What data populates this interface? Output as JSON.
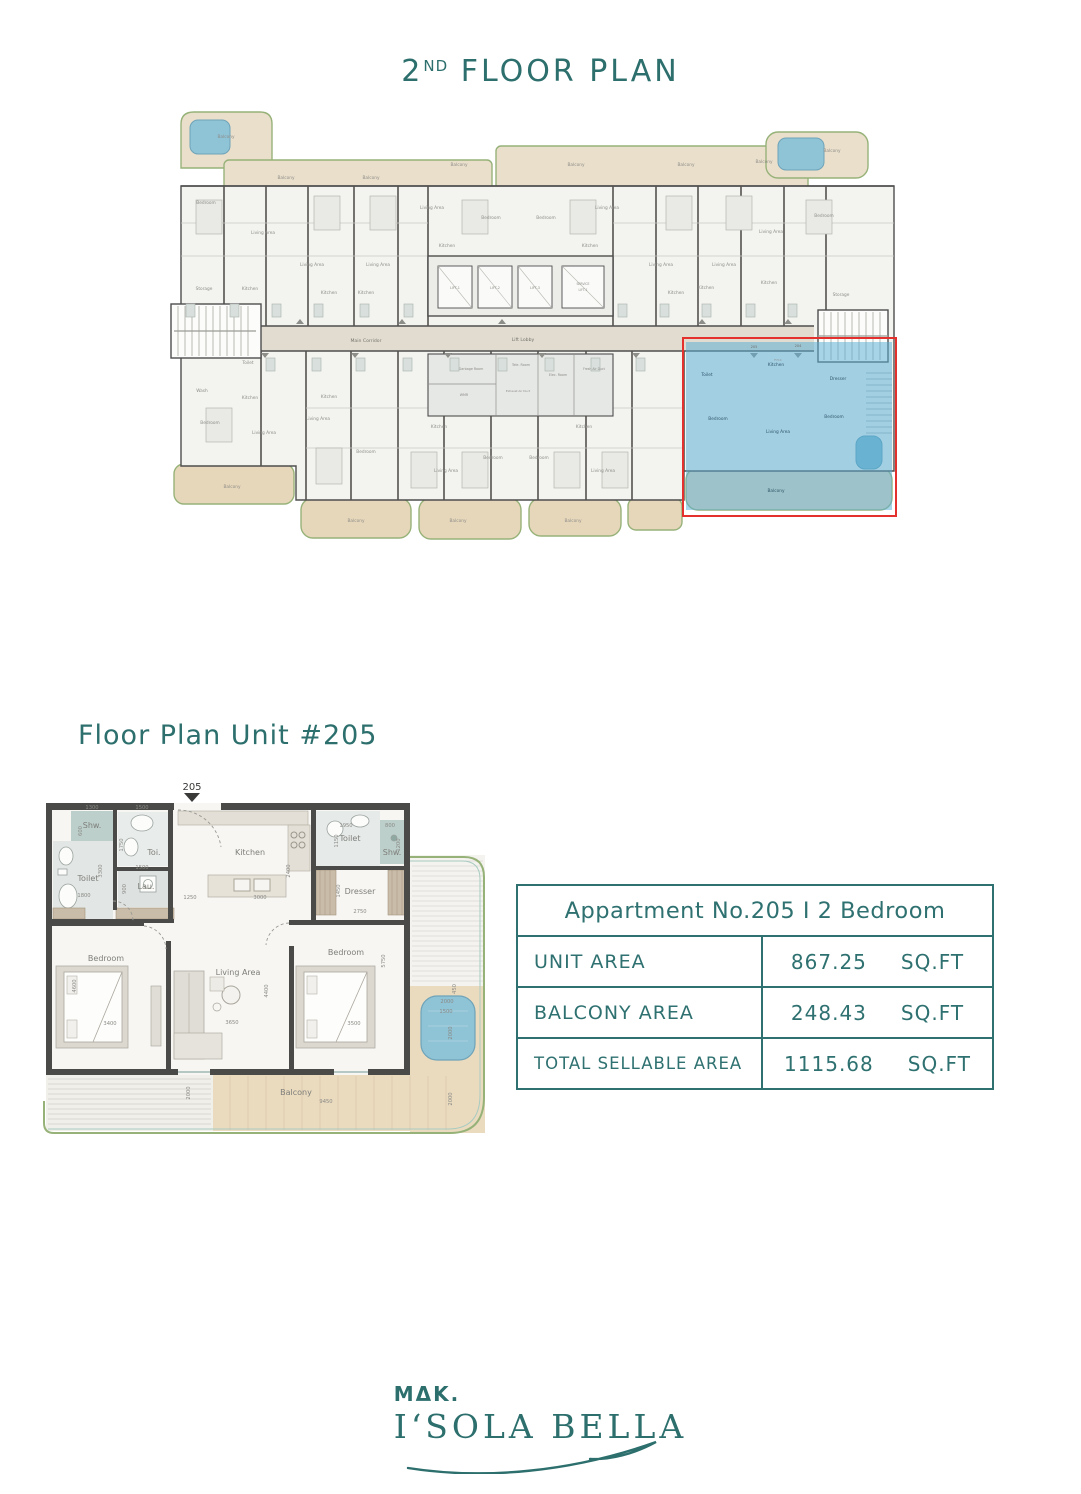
{
  "titles": {
    "floor_prefix": "2",
    "floor_sup": "ND",
    "floor_rest": " FLOOR PLAN",
    "unit_section": "Floor Plan Unit #205",
    "unit_entry_marker": "205"
  },
  "colors": {
    "teal_text": "#2C6F6D",
    "table_border": "#2E7170",
    "highlight_fill": "#5AAFD6",
    "highlight_border_red": "#E4312D",
    "balcony_beige": "#EADFCB",
    "deck_wood": "#EADBBF",
    "pool_blue": "#8FC3D6",
    "wall_gray": "#4E4E4E",
    "trim_green": "#97B279"
  },
  "info_table": {
    "header": "Appartment No.205 I   2 Bedroom",
    "rows": [
      {
        "label": "UNIT AREA",
        "value": "867.25",
        "unit": "SQ.FT"
      },
      {
        "label": "BALCONY AREA",
        "value": "248.43",
        "unit": "SQ.FT"
      },
      {
        "label": "TOTAL SELLABLE AREA",
        "value": "1115.68",
        "unit": "SQ.FT"
      }
    ]
  },
  "logo": {
    "brand": "MΔK.",
    "name": "I‘SOLA BELLA"
  },
  "building_plan": {
    "labels": [
      {
        "t": "Balcony",
        "x": 60,
        "y": 30
      },
      {
        "t": "Balcony",
        "x": 120,
        "y": 71
      },
      {
        "t": "Balcony",
        "x": 205,
        "y": 71
      },
      {
        "t": "Balcony",
        "x": 293,
        "y": 58
      },
      {
        "t": "Balcony",
        "x": 410,
        "y": 58
      },
      {
        "t": "Balcony",
        "x": 520,
        "y": 58
      },
      {
        "t": "Balcony",
        "x": 598,
        "y": 55
      },
      {
        "t": "Balcony",
        "x": 666,
        "y": 44
      },
      {
        "t": "Bedroom",
        "x": 40,
        "y": 96
      },
      {
        "t": "Living Area",
        "x": 97,
        "y": 126
      },
      {
        "t": "Storage",
        "x": 38,
        "y": 182
      },
      {
        "t": "Kitchen",
        "x": 84,
        "y": 182
      },
      {
        "t": "Living Area",
        "x": 146,
        "y": 158
      },
      {
        "t": "Kitchen",
        "x": 163,
        "y": 186
      },
      {
        "t": "Living Area",
        "x": 212,
        "y": 158
      },
      {
        "t": "Kitchen",
        "x": 200,
        "y": 186
      },
      {
        "t": "Living Area",
        "x": 266,
        "y": 101
      },
      {
        "t": "Kitchen",
        "x": 281,
        "y": 139
      },
      {
        "t": "Bedroom",
        "x": 325,
        "y": 111
      },
      {
        "t": "Bedroom",
        "x": 380,
        "y": 111
      },
      {
        "t": "Living Area",
        "x": 441,
        "y": 101
      },
      {
        "t": "Kitchen",
        "x": 424,
        "y": 139
      },
      {
        "t": "Living Area",
        "x": 495,
        "y": 158
      },
      {
        "t": "Kitchen",
        "x": 510,
        "y": 186
      },
      {
        "t": "Living Area",
        "x": 558,
        "y": 158
      },
      {
        "t": "Kitchen",
        "x": 540,
        "y": 181
      },
      {
        "t": "Living Area",
        "x": 605,
        "y": 125
      },
      {
        "t": "Bedroom",
        "x": 658,
        "y": 109
      },
      {
        "t": "Kitchen",
        "x": 603,
        "y": 176
      },
      {
        "t": "Storage",
        "x": 675,
        "y": 188
      },
      {
        "t": "Main Corridor",
        "x": 200,
        "y": 234,
        "s": 4.6,
        "c": "#76756F"
      },
      {
        "t": "Lift Lobby",
        "x": 357,
        "y": 233,
        "s": 4.6,
        "c": "#76756F"
      },
      {
        "t": "LIFT-1",
        "x": 289,
        "y": 181,
        "s": 3.4
      },
      {
        "t": "LIFT-2",
        "x": 329,
        "y": 181,
        "s": 3.4
      },
      {
        "t": "LIFT-3",
        "x": 369,
        "y": 181,
        "s": 3.4
      },
      {
        "t": "SERVICE",
        "x": 417,
        "y": 177,
        "s": 3.1
      },
      {
        "t": "LIFT-1",
        "x": 417,
        "y": 183,
        "s": 3.1
      },
      {
        "t": "Garbage Room",
        "x": 305,
        "y": 262,
        "s": 3.3
      },
      {
        "t": "WMR",
        "x": 298,
        "y": 288,
        "s": 3.3
      },
      {
        "t": "Tele. Room",
        "x": 355,
        "y": 258,
        "s": 3.3
      },
      {
        "t": "Exhaust Air Duct",
        "x": 352,
        "y": 284,
        "s": 2.9
      },
      {
        "t": "Elec. Room",
        "x": 392,
        "y": 268,
        "s": 3.3
      },
      {
        "t": "Fresh Air Duct",
        "x": 428,
        "y": 262,
        "s": 3.1
      },
      {
        "t": "Toilet",
        "x": 82,
        "y": 256
      },
      {
        "t": "Wash",
        "x": 36,
        "y": 284
      },
      {
        "t": "Kitchen",
        "x": 84,
        "y": 291
      },
      {
        "t": "Bedroom",
        "x": 44,
        "y": 316
      },
      {
        "t": "Living Area",
        "x": 98,
        "y": 326
      },
      {
        "t": "Balcony",
        "x": 66,
        "y": 380
      },
      {
        "t": "Kitchen",
        "x": 163,
        "y": 290
      },
      {
        "t": "Living Area",
        "x": 152,
        "y": 312
      },
      {
        "t": "Bedroom",
        "x": 200,
        "y": 345
      },
      {
        "t": "Balcony",
        "x": 190,
        "y": 414
      },
      {
        "t": "Kitchen",
        "x": 273,
        "y": 320
      },
      {
        "t": "Bedroom",
        "x": 327,
        "y": 351
      },
      {
        "t": "Living Area",
        "x": 280,
        "y": 364
      },
      {
        "t": "Balcony",
        "x": 292,
        "y": 414
      },
      {
        "t": "Kitchen",
        "x": 418,
        "y": 320
      },
      {
        "t": "Bedroom",
        "x": 373,
        "y": 351
      },
      {
        "t": "Living Area",
        "x": 437,
        "y": 364
      },
      {
        "t": "Balcony",
        "x": 407,
        "y": 414
      },
      {
        "t": "205",
        "x": 588,
        "y": 240,
        "s": 3.6,
        "c": "#6E6E68"
      },
      {
        "t": "204",
        "x": 632,
        "y": 239,
        "s": 3.6,
        "c": "#6E6E68"
      },
      {
        "t": "F.H.C",
        "x": 612,
        "y": 253,
        "s": 3.0
      }
    ],
    "highlight_labels": [
      {
        "t": "Toilet",
        "x": 541,
        "y": 268
      },
      {
        "t": "Kitchen",
        "x": 610,
        "y": 258
      },
      {
        "t": "Dresser",
        "x": 672,
        "y": 272
      },
      {
        "t": "Bedroom",
        "x": 552,
        "y": 312
      },
      {
        "t": "Living Area",
        "x": 612,
        "y": 325
      },
      {
        "t": "Bedroom",
        "x": 668,
        "y": 310
      },
      {
        "t": "Balcony",
        "x": 610,
        "y": 384
      }
    ]
  },
  "unit_plan": {
    "rooms": [
      {
        "t": "Shw.",
        "x": 54,
        "y": 47
      },
      {
        "t": "Toi.",
        "x": 116,
        "y": 74
      },
      {
        "t": "Toilet",
        "x": 50,
        "y": 100
      },
      {
        "t": "Lau.",
        "x": 108,
        "y": 108
      },
      {
        "t": "Kitchen",
        "x": 212,
        "y": 74
      },
      {
        "t": "Toilet",
        "x": 312,
        "y": 60
      },
      {
        "t": "Shw.",
        "x": 354,
        "y": 74
      },
      {
        "t": "Dresser",
        "x": 322,
        "y": 113
      },
      {
        "t": "Bedroom",
        "x": 68,
        "y": 180
      },
      {
        "t": "Living Area",
        "x": 200,
        "y": 194
      },
      {
        "t": "Bedroom",
        "x": 308,
        "y": 174
      },
      {
        "t": "Balcony",
        "x": 258,
        "y": 314
      }
    ],
    "dims": [
      {
        "t": "1300",
        "x": 54,
        "y": 28
      },
      {
        "t": "600",
        "x": 44,
        "y": 50,
        "r": 1
      },
      {
        "t": "1500",
        "x": 104,
        "y": 28
      },
      {
        "t": "1750",
        "x": 85,
        "y": 64,
        "r": 1
      },
      {
        "t": "3300",
        "x": 64,
        "y": 90,
        "r": 1
      },
      {
        "t": "1800",
        "x": 46,
        "y": 116
      },
      {
        "t": "1500",
        "x": 104,
        "y": 88
      },
      {
        "t": "900",
        "x": 88,
        "y": 108,
        "r": 1
      },
      {
        "t": "1250",
        "x": 152,
        "y": 118
      },
      {
        "t": "3000",
        "x": 222,
        "y": 118
      },
      {
        "t": "2400",
        "x": 252,
        "y": 90,
        "r": 1
      },
      {
        "t": "1950",
        "x": 308,
        "y": 46
      },
      {
        "t": "1150",
        "x": 300,
        "y": 60,
        "r": 1
      },
      {
        "t": "800",
        "x": 352,
        "y": 46
      },
      {
        "t": "1200",
        "x": 362,
        "y": 64,
        "r": 1
      },
      {
        "t": "1450",
        "x": 302,
        "y": 110,
        "r": 1
      },
      {
        "t": "2750",
        "x": 322,
        "y": 132
      },
      {
        "t": "4600",
        "x": 38,
        "y": 205,
        "r": 1
      },
      {
        "t": "3400",
        "x": 72,
        "y": 244
      },
      {
        "t": "4400",
        "x": 230,
        "y": 210,
        "r": 1
      },
      {
        "t": "3650",
        "x": 194,
        "y": 243
      },
      {
        "t": "5750",
        "x": 347,
        "y": 180,
        "r": 1
      },
      {
        "t": "3500",
        "x": 316,
        "y": 244
      },
      {
        "t": "450",
        "x": 418,
        "y": 208,
        "r": 1
      },
      {
        "t": "2000",
        "x": 409,
        "y": 222
      },
      {
        "t": "1500",
        "x": 408,
        "y": 232
      },
      {
        "t": "2000",
        "x": 414,
        "y": 252,
        "r": 1
      },
      {
        "t": "2000",
        "x": 152,
        "y": 312,
        "r": 1
      },
      {
        "t": "9450",
        "x": 288,
        "y": 322
      },
      {
        "t": "2000",
        "x": 414,
        "y": 318,
        "r": 1
      }
    ]
  }
}
